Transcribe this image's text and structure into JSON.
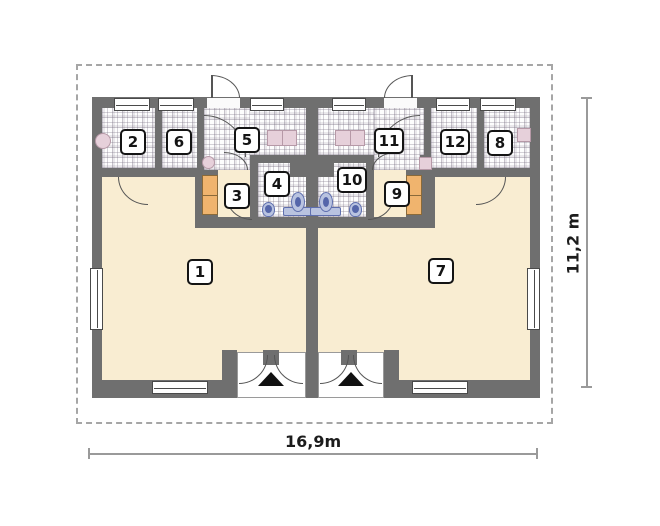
{
  "plan": {
    "room_numbers": [
      "1",
      "2",
      "3",
      "4",
      "5",
      "6",
      "7",
      "8",
      "9",
      "10",
      "11",
      "12"
    ],
    "dimensions": {
      "width_label": "16,9m",
      "height_label": "11,2 m"
    },
    "colors": {
      "wall": "#6f6f6f",
      "floor_cream": "#f9edd2",
      "boundary": "#a6a6a6",
      "fixture_pink": "#e6d0da",
      "fixture_blue": "#5566aa",
      "stairs_orange": "#f0b46e"
    }
  }
}
